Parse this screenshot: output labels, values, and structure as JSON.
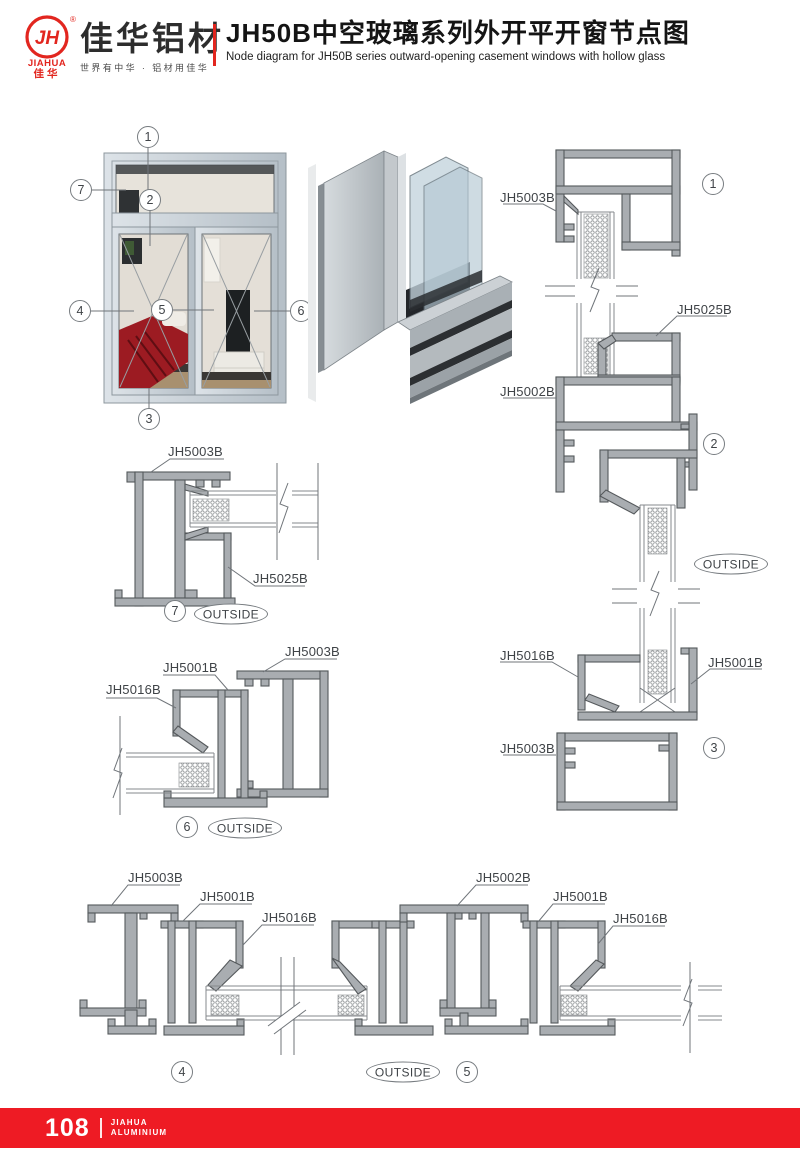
{
  "header": {
    "logo": {
      "monogram": "JH",
      "registered_mark": "®",
      "name_en": "JIAHUA",
      "name_cn": "佳华",
      "brand": "佳华铝材",
      "slogan": "世界有中华 · 铝材用佳华"
    },
    "title_cn": "JH50B中空玻璃系列外开平开窗节点图",
    "title_en": "Node diagram for JH50B series outward-opening casement windows with hollow glass"
  },
  "colors": {
    "brand_red": "#e2261f",
    "footer_red": "#ee1b24",
    "drawing_line": "#55595c",
    "profile_fill": "#a9adb1"
  },
  "elevation": {
    "callouts": {
      "c1": "1",
      "c2": "2",
      "c3": "3",
      "c4": "4",
      "c5": "5",
      "c6": "6",
      "c7": "7"
    }
  },
  "details": {
    "d1": {
      "num": "1",
      "label_top": "JH5003B",
      "label_mid": "JH5025B",
      "label_bottom": "JH5002B"
    },
    "d2": {
      "num": "2",
      "outside": "OUTSIDE"
    },
    "d3": {
      "num": "3",
      "label_left": "JH5016B",
      "label_right": "JH5001B",
      "label_bottom": "JH5003B"
    },
    "d7": {
      "num": "7",
      "outside": "OUTSIDE",
      "label_top": "JH5003B",
      "label_bottom": "JH5025B"
    },
    "d6": {
      "num": "6",
      "outside": "OUTSIDE",
      "label_left": "JH5016B",
      "label_mid": "JH5001B",
      "label_right": "JH5003B"
    },
    "d4": {
      "num": "4",
      "label_1": "JH5003B",
      "label_2": "JH5001B",
      "label_3": "JH5016B"
    },
    "d5": {
      "num": "5",
      "outside": "OUTSIDE",
      "label_1": "JH5002B",
      "label_2": "JH5001B",
      "label_3": "JH5016B"
    }
  },
  "footer": {
    "page_number": "108",
    "brand_line1": "JIAHUA",
    "brand_line2": "ALUMINIUM"
  }
}
